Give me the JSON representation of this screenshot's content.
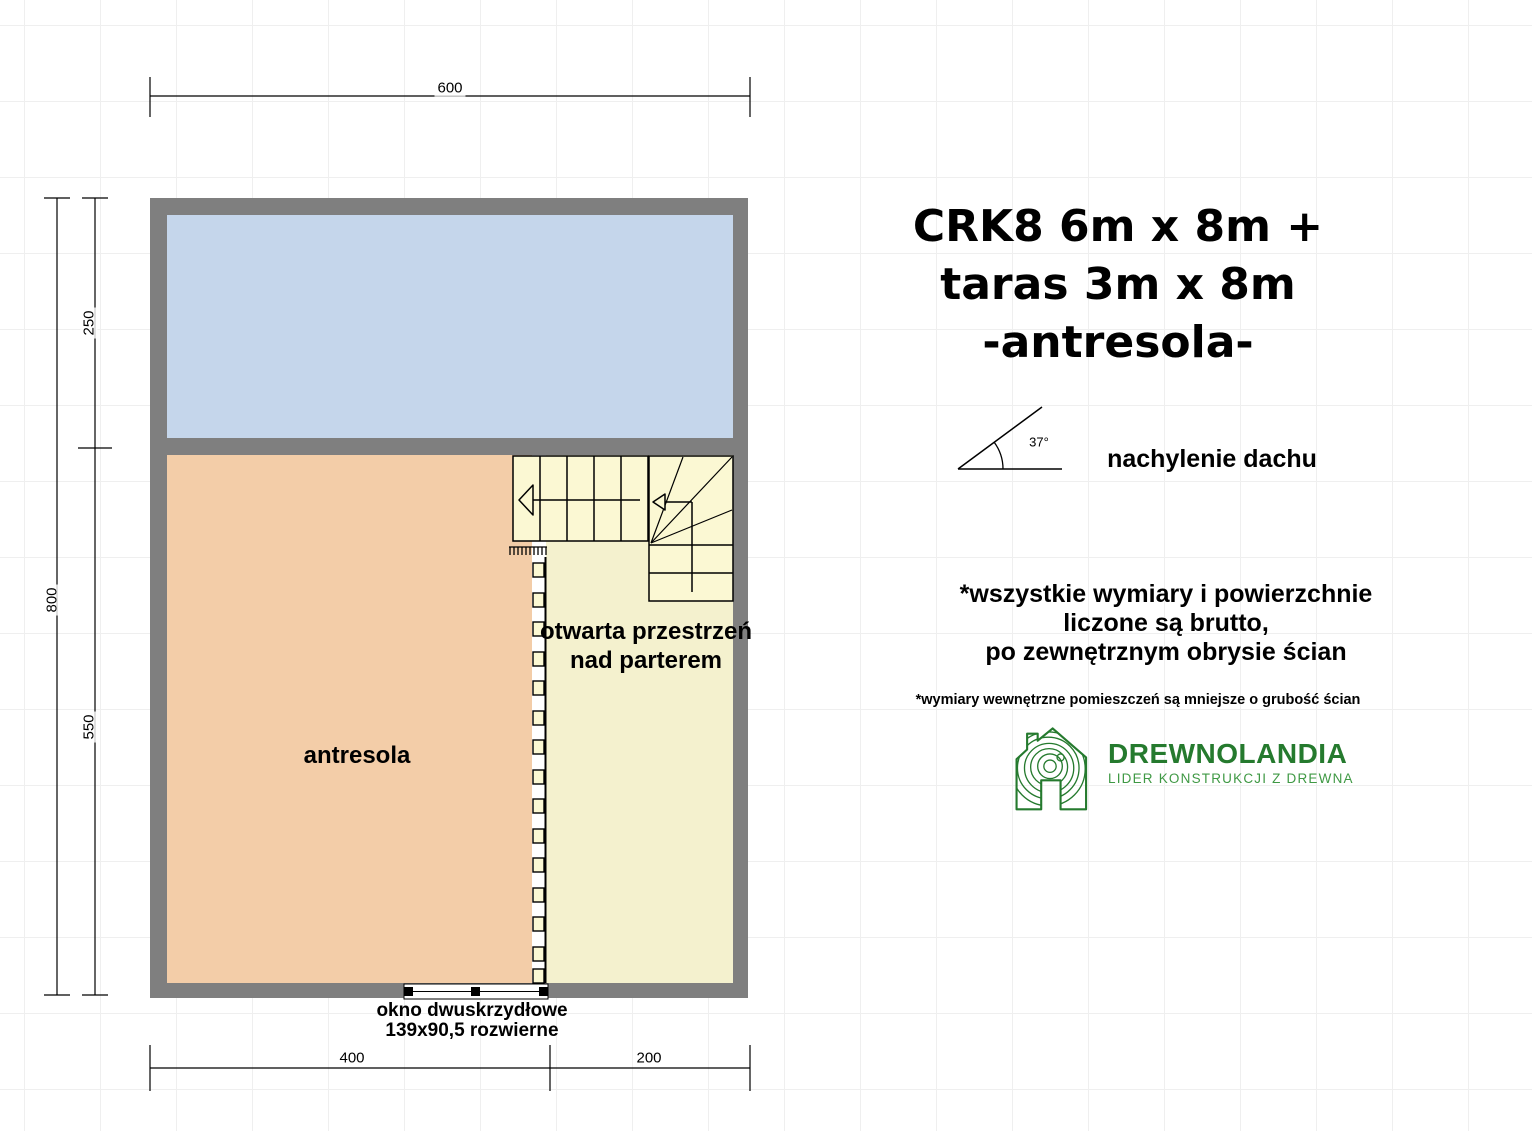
{
  "title": {
    "line1": "CRK8 6m x 8m +",
    "line2": "taras 3m x 8m",
    "line3": "-antresola-"
  },
  "roof": {
    "angle": "37°",
    "label": "nachylenie dachu"
  },
  "notes": {
    "bold_line1": "*wszystkie wymiary i powierzchnie",
    "bold_line2": "liczone są brutto,",
    "bold_line3": "po zewnętrznym obrysie ścian",
    "small": "*wymiary wewnętrzne pomieszczeń są mniejsze o grubość ścian"
  },
  "logo": {
    "name": "DREWNOLANDIA",
    "tagline": "LIDER KONSTRUKCJI Z DREWNA"
  },
  "plan": {
    "room_label": "antresola",
    "open_space_line1": "otwarta przestrzeń",
    "open_space_line2": "nad parterem",
    "window_line1": "okno dwuskrzydłowe",
    "window_line2": "139x90,5 rozwierne",
    "dimensions": {
      "top_width": "600",
      "left_total": "800",
      "left_upper": "250",
      "left_lower": "550",
      "bottom_left": "400",
      "bottom_right": "200"
    }
  },
  "icons": {
    "roof_pitch": "roof-pitch-angle-icon",
    "logo_house": "house-wood-rings-icon",
    "stair_arrows": "stair-direction-arrow"
  },
  "colors": {
    "wall": "#7f7f7f",
    "terrace_fill": "#c9dbf1",
    "antresola_fill": "#fad2ab",
    "open_space_fill": "#fbf8d3",
    "logo_green": "#257a2e",
    "logo_green_light": "#3f9944"
  }
}
